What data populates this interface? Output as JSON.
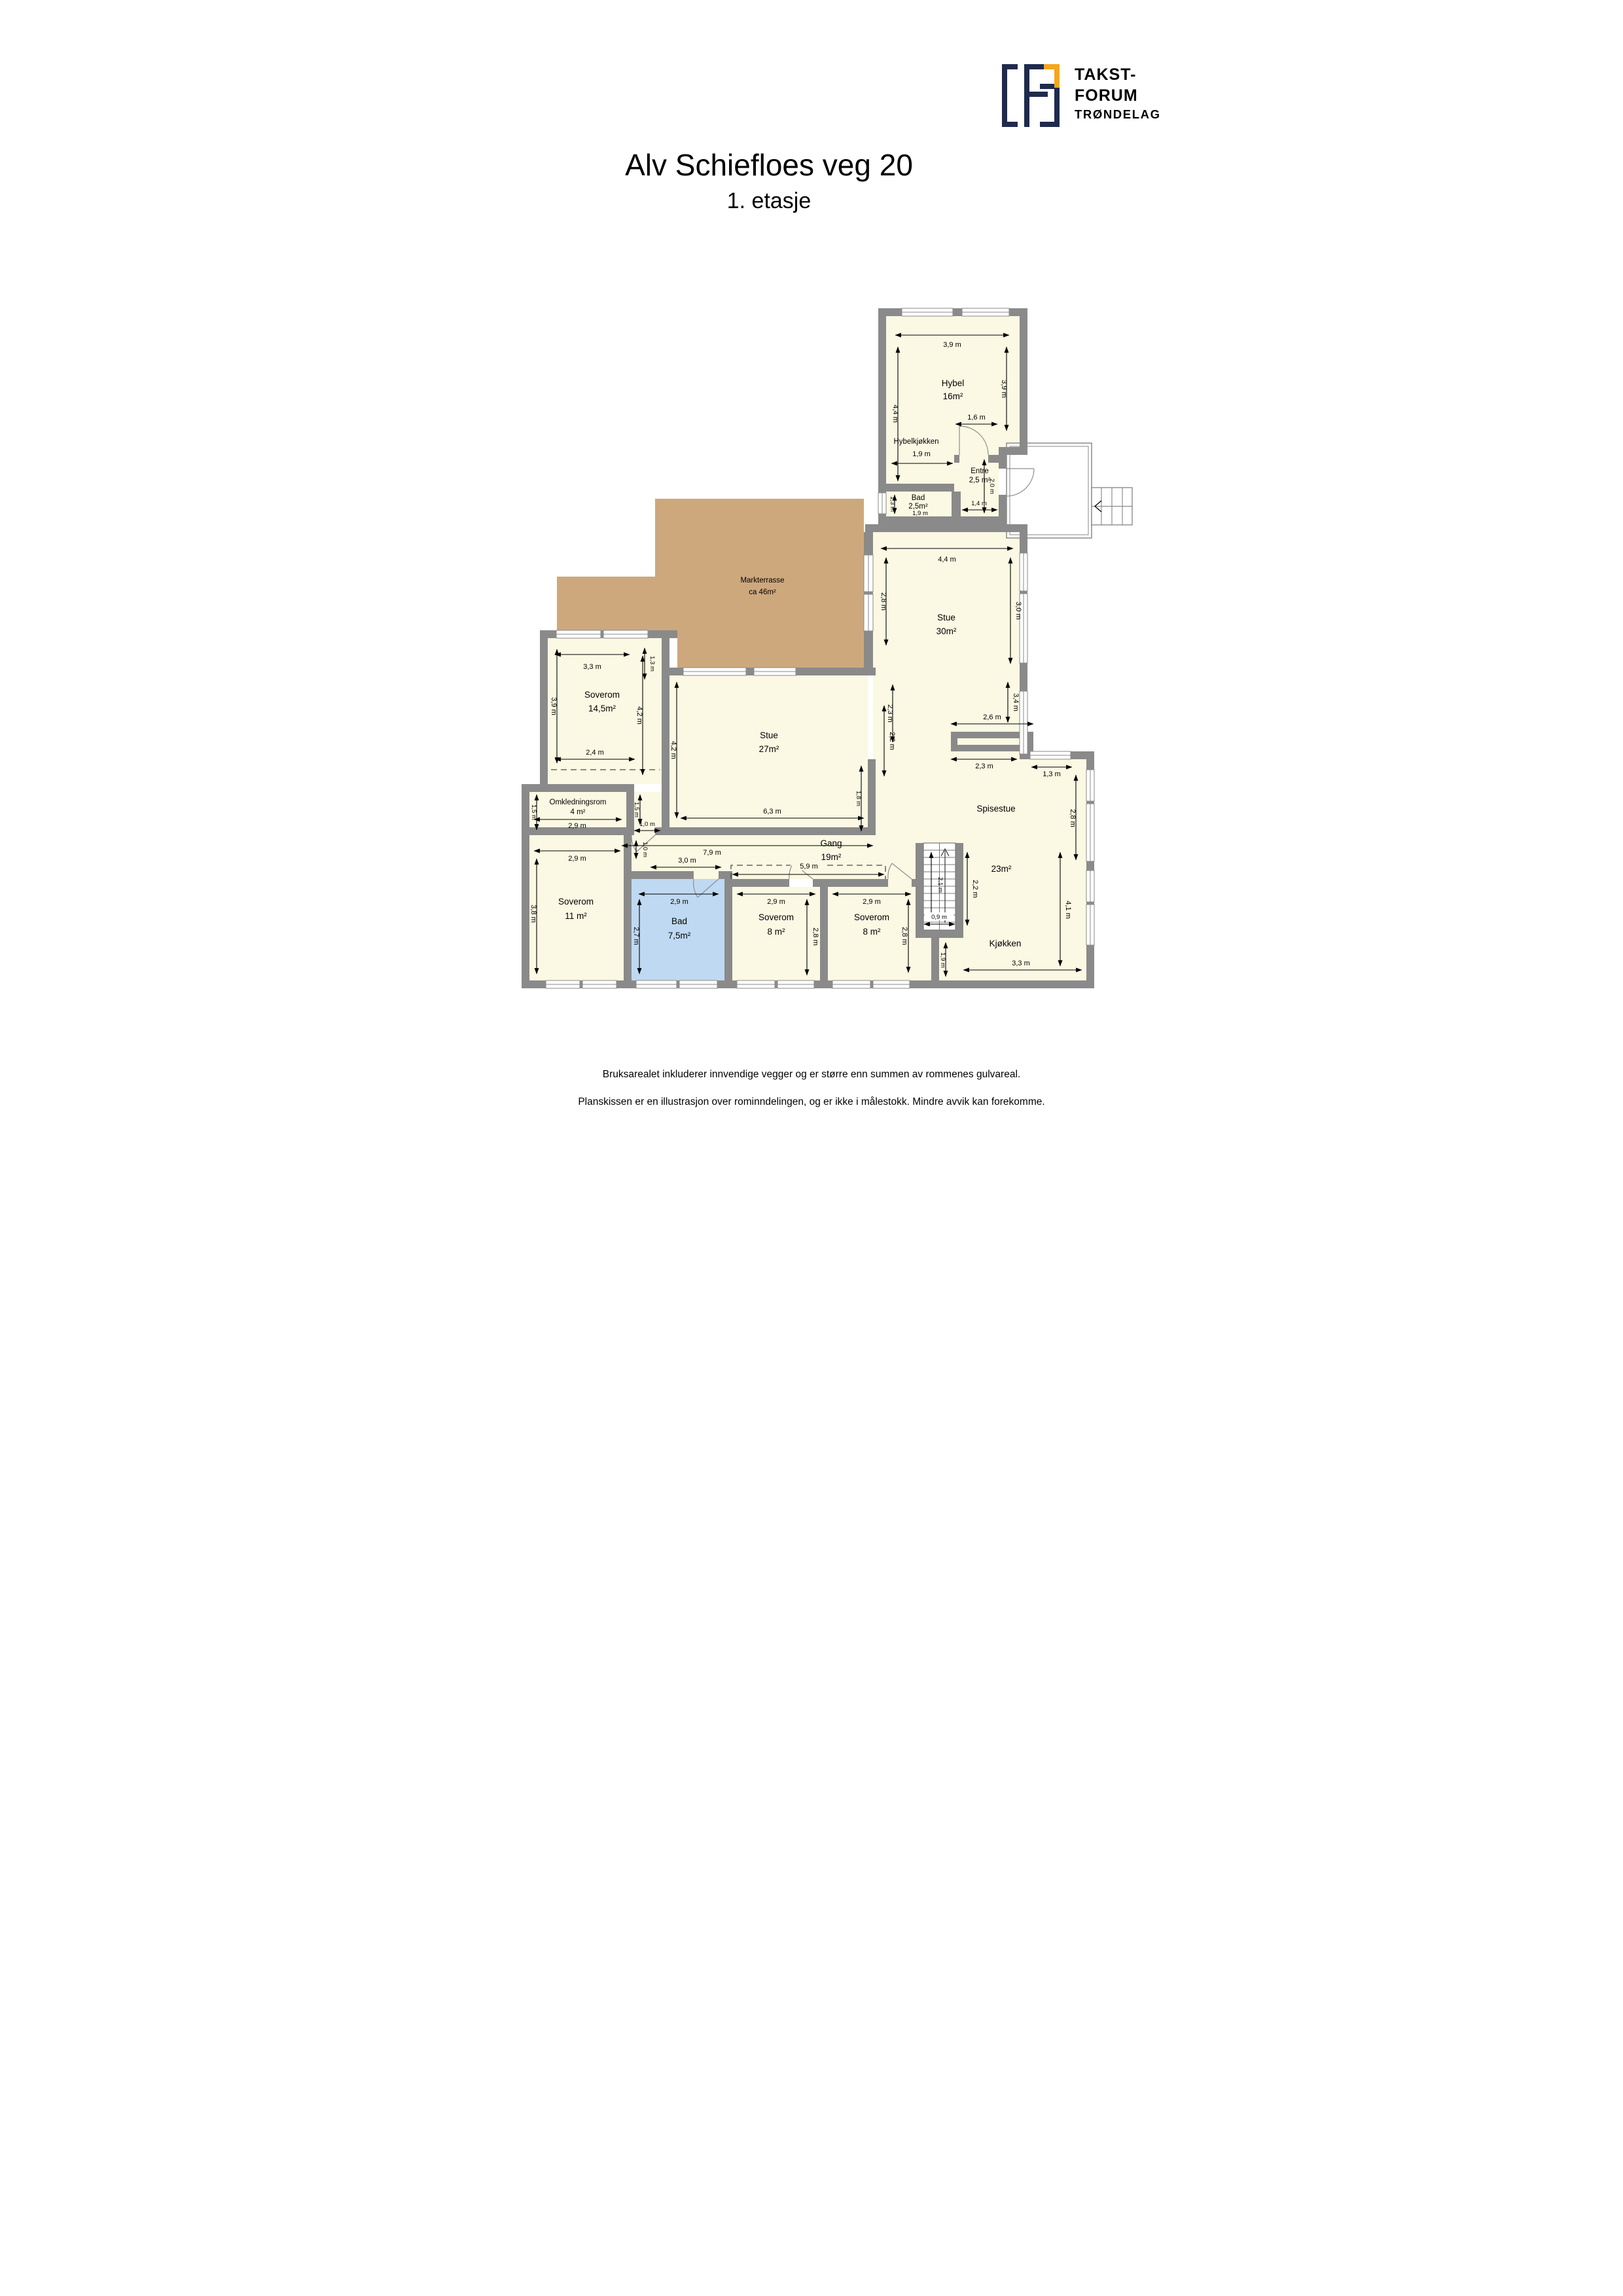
{
  "header": {
    "title": "Alv Schiefloes veg 20",
    "subtitle": "1. etasje"
  },
  "logo": {
    "line1": "TAKST-",
    "line2": "FORUM",
    "line3": "TRØNDELAG",
    "navy": "#1E2B4E",
    "orange": "#F6A619"
  },
  "plan": {
    "colors": {
      "wall": "#8A8A8A",
      "room": "#FBF8E3",
      "bath": "#BFD9F2",
      "terrace": "#CDA87D"
    },
    "rooms": {
      "hybel": {
        "name": "Hybel",
        "area": "16m²"
      },
      "hybelkjokken": {
        "name": "Hybelkjøkken"
      },
      "bad1": {
        "name": "Bad",
        "area": "2,5m²"
      },
      "entre": {
        "name": "Entre",
        "area": "2,5 m²"
      },
      "markterrasse": {
        "name": "Markterrasse",
        "area": "ca 46m²"
      },
      "stue30": {
        "name": "Stue",
        "area": "30m²"
      },
      "soverom145": {
        "name": "Soverom",
        "area": "14,5m²"
      },
      "stue27": {
        "name": "Stue",
        "area": "27m²"
      },
      "omkledningsrom": {
        "name": "Omkledningsrom",
        "area": "4 m²"
      },
      "spisestue": {
        "name": "Spisestue"
      },
      "gang": {
        "name": "Gang",
        "area": "19m²"
      },
      "soverom11": {
        "name": "Soverom",
        "area": "11 m²"
      },
      "bad75": {
        "name": "Bad",
        "area": "7,5m²"
      },
      "soverom8a": {
        "name": "Soverom",
        "area": "8 m²"
      },
      "soverom8b": {
        "name": "Soverom",
        "area": "8 m²"
      },
      "open23": {
        "area": "23m²"
      },
      "kjokken": {
        "name": "Kjøkken"
      }
    },
    "dims": {
      "hybel_w": "3,9 m",
      "hybel_h": "4,4 m",
      "hybel_e": "3,9 m",
      "hybel_door": "1,6 m",
      "hybelkj_w": "1,9 m",
      "bad1_h": "1,3 m",
      "bad1_w": "1,9 m",
      "entre_h": "2,0 m",
      "entre_w": "1,4 m",
      "stue30_w": "4,4 m",
      "stue30_nw": "2,8 m",
      "stue30_ne": "3,0 m",
      "stue30_sw": "2,3 m",
      "stue30_se": "3,4 m",
      "fireplace_w": "2,6 m",
      "s145_w": "3,3 m",
      "s145_win": "1,3 m",
      "s145_h": "3,9 m",
      "s145_s": "2,4 m",
      "s145_e": "4,2 m",
      "stue27_w_dim": "4,2 m",
      "stue27_s": "6,3 m",
      "stue27_stub": "1,8 m",
      "stue27_e": "2,2 m",
      "omkl_h": "1,5 m",
      "omkl_w": "2,9 m",
      "pass_h": "1,5 m",
      "pass_w": "1,0 m",
      "sov11_w": "2,9 m",
      "sov11_h": "3,8 m",
      "sov11_door": "1,0 m",
      "bad75_n": "3,0 m",
      "bad75_w": "2,9 m",
      "bad75_h": "2,7 m",
      "gang_w": "7,9 m",
      "gang_ward": "5,9 m",
      "s8a_w": "2,9 m",
      "s8a_h": "2,8 m",
      "s8b_w": "2,9 m",
      "s8b_h": "2,8 m",
      "stairs_h": "2,1 m",
      "stairs_w": "0,9 m",
      "open23_w": "2,2 m",
      "kjok_e": "4,1 m",
      "kjok_wl": "1,9 m",
      "kjok_s": "3,3 m",
      "spis_n": "2,3 m",
      "spis_win": "1,3 m",
      "spis_e": "2,8 m"
    }
  },
  "footer": {
    "line1": "Bruksarealet inkluderer innvendige vegger og er større enn summen av rommenes gulvareal.",
    "line2": "Planskissen er en illustrasjon over rominndelingen, og er ikke i målestokk. Mindre avvik kan forekomme."
  }
}
